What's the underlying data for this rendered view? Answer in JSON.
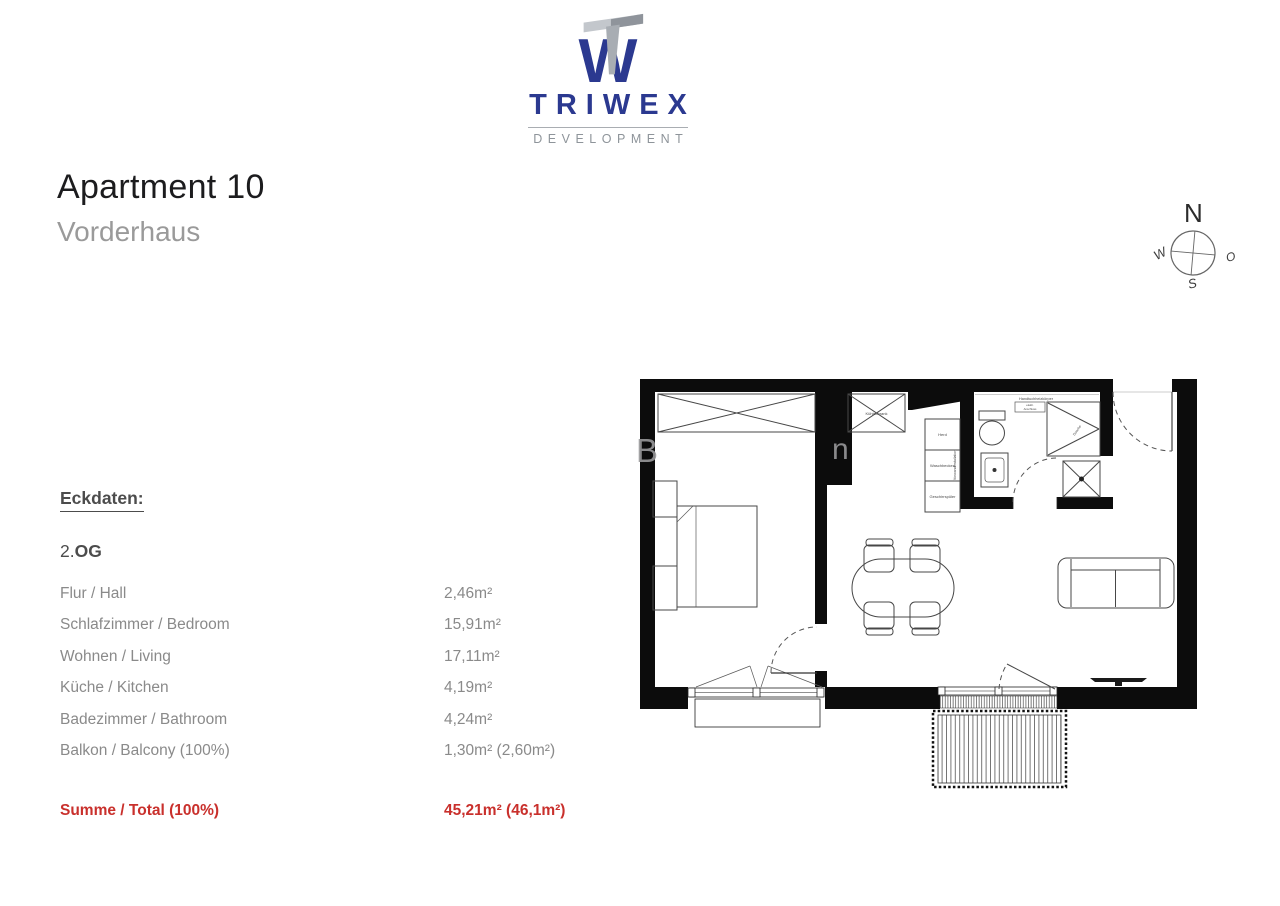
{
  "brand": {
    "name": "TRIWEX",
    "tagline": "DEVELOPMENT",
    "colors": {
      "blue": "#2b3990",
      "gray": "#9399a0"
    }
  },
  "header": {
    "title": "Apartment 10",
    "subtitle": "Vorderhaus"
  },
  "compass": {
    "north": "N",
    "east": "O",
    "south": "S",
    "west": "W"
  },
  "eckdaten": {
    "heading": "Eckdaten:",
    "floor_prefix": "2.",
    "floor_label": "OG",
    "rows": [
      {
        "label": "Flur / Hall",
        "value": "2,46m²"
      },
      {
        "label": "Schlafzimmer / Bedroom",
        "value": "15,91m²"
      },
      {
        "label": "Wohnen / Living",
        "value": "17,11m²"
      },
      {
        "label": "Küche / Kitchen",
        "value": "4,19m²"
      },
      {
        "label": "Badezimmer / Bathroom",
        "value": "4,24m²"
      },
      {
        "label": "Balkon / Balcony (100%)",
        "value": "1,30m² (2,60m²)"
      }
    ],
    "total": {
      "label": "Summe / Total (100%)",
      "value": "45,21m² (46,1m²)"
    },
    "accent_red": "#c9302c"
  },
  "floorplan": {
    "kitchen": {
      "fridge_label": "Kühlschrank",
      "stove_label": "Herd",
      "sink_label": "Waschbecken",
      "dishwasher_label": "Geschirrspüler",
      "shaft_note": "Vorwandinstallation"
    },
    "bathroom": {
      "radiator_label": "Handtuchheizkörper",
      "note_line1": "elektr.",
      "note_line2": "Anschluss",
      "shower_label": "Dusche"
    },
    "watermark": {
      "fragment_left": "B",
      "fragment_mid": "n"
    }
  }
}
